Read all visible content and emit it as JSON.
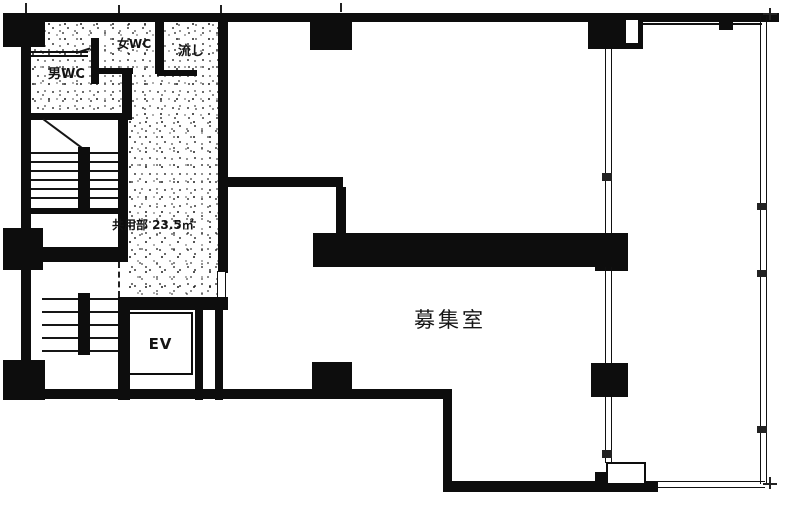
{
  "floorplan": {
    "labels": {
      "womens_wc": "女WC",
      "mens_wc": "男WC",
      "sink": "流し",
      "common_area": "共用部  23.5㎡",
      "elevator": "EV",
      "vacant_room": "募集室"
    },
    "colors": {
      "wall": "#0d0d0d",
      "background": "#ffffff",
      "text": "#141414"
    }
  }
}
